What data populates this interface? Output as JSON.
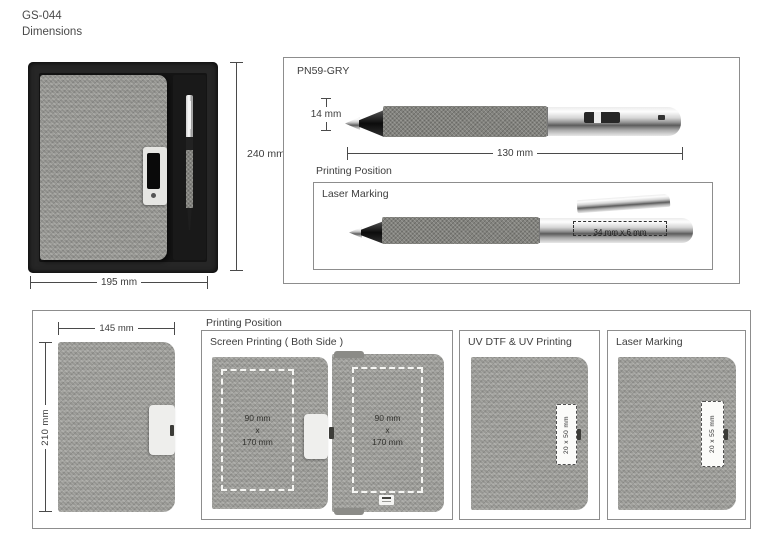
{
  "header": {
    "code": "GS-044",
    "title": "Dimensions"
  },
  "colors": {
    "fabric_gray": "#9f9f9b",
    "pen_fabric_gray": "#83837e",
    "box_black": "#262626",
    "panel_border": "#8d8d8d"
  },
  "gift_box": {
    "height": "240 mm",
    "width": "195 mm"
  },
  "pen_section": {
    "code": "PN59-GRY",
    "diameter": "14 mm",
    "length": "130 mm",
    "printing_position": "Printing Position",
    "laser_marking": {
      "title": "Laser Marking",
      "area": "34 mm x 6 mm"
    }
  },
  "notebook_section": {
    "printing_position": "Printing Position",
    "width": "145 mm",
    "height": "210 mm",
    "screen_printing": {
      "title": "Screen Printing ( Both Side )",
      "front_area": {
        "line1": "90 mm",
        "line2": "x",
        "line3": "170 mm"
      },
      "back_area": {
        "line1": "90 mm",
        "line2": "x",
        "line3": "170 mm"
      }
    },
    "uv_printing": {
      "title": "UV DTF & UV Printing",
      "area": "20 x 50 mm"
    },
    "laser_marking": {
      "title": "Laser Marking",
      "area": "20 x 55 mm"
    }
  }
}
